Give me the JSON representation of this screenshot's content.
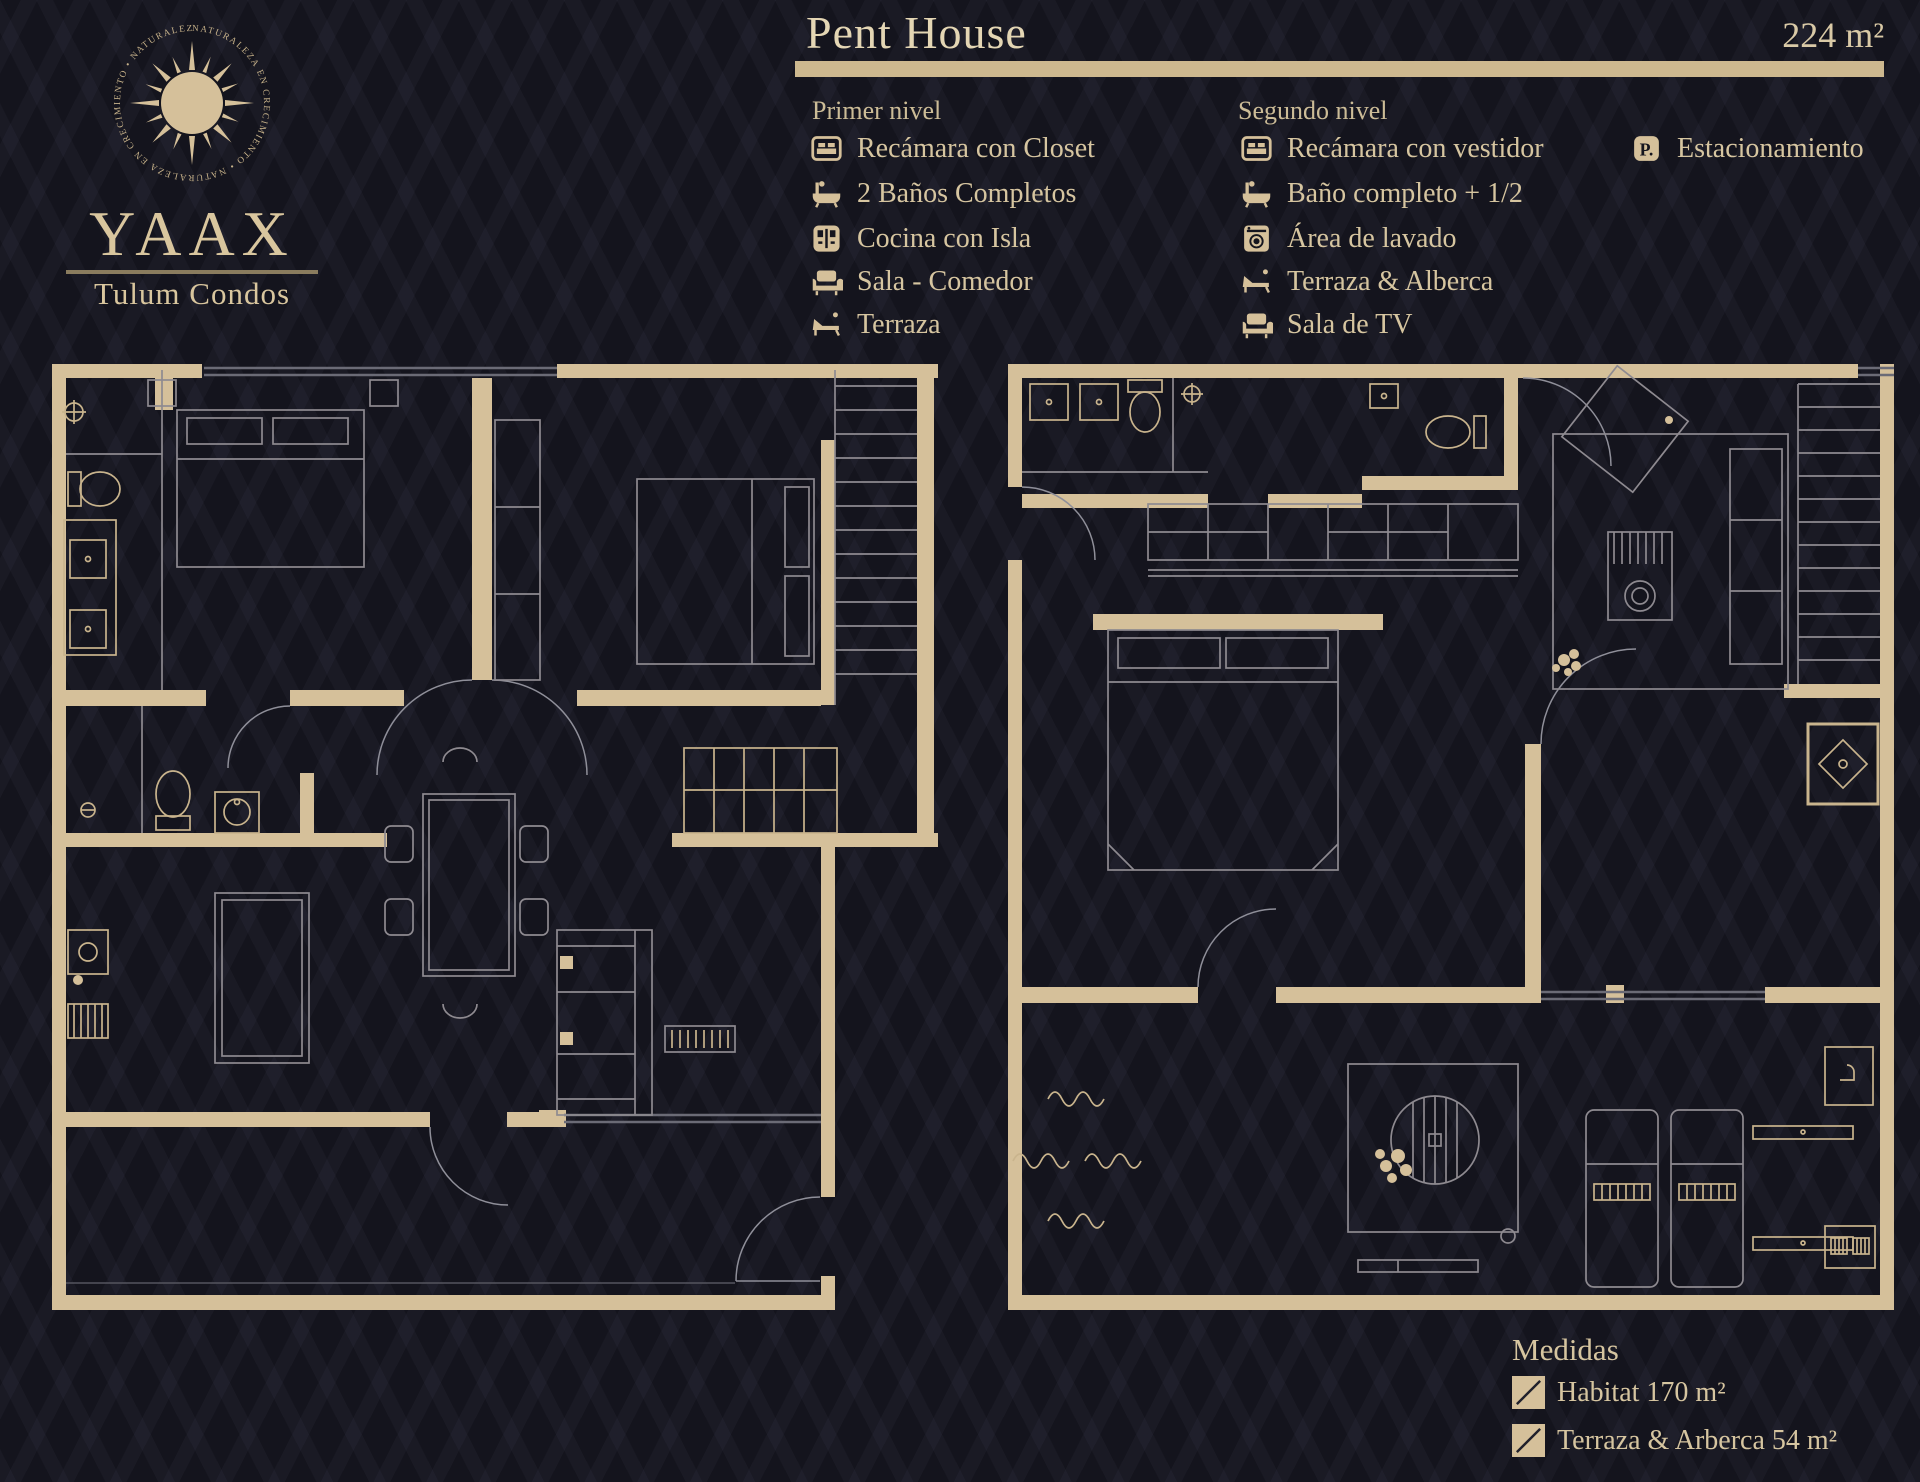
{
  "brand": {
    "name": "YAAX",
    "subtitle": "Tulum Condos",
    "ring_text": "NATURALEZA EN CRECIMIENTO • NATURALEZA EN CRECIMIENTO • NATURALEZA EN CRECIMIENTO • "
  },
  "header": {
    "title": "Pent House",
    "area": "224 m²"
  },
  "levels": [
    {
      "label": "Primer nivel",
      "items": [
        {
          "icon": "bed-icon",
          "label": "Recámara con Closet"
        },
        {
          "icon": "bath-icon",
          "label": "2 Baños Completos"
        },
        {
          "icon": "kitchen-icon",
          "label": "Cocina con Isla"
        },
        {
          "icon": "sofa-icon",
          "label": "Sala - Comedor"
        },
        {
          "icon": "lounge-icon",
          "label": "Terraza"
        }
      ]
    },
    {
      "label": "Segundo nivel",
      "items": [
        {
          "icon": "bed-icon",
          "label": "Recámara con vestidor"
        },
        {
          "icon": "bath-icon",
          "label": "Baño completo + 1/2"
        },
        {
          "icon": "washer-icon",
          "label": "Área de lavado"
        },
        {
          "icon": "lounge-icon",
          "label": "Terraza & Alberca"
        },
        {
          "icon": "sofa-icon",
          "label": "Sala de TV"
        }
      ]
    }
  ],
  "extra_feature": {
    "icon": "parking-icon",
    "label": "Estacionamiento"
  },
  "legend": {
    "title": "Medidas",
    "entries": [
      {
        "label": "Habitat 170 m²"
      },
      {
        "label": "Terraza & Arberca 54 m²"
      }
    ]
  },
  "floorplans": [
    {
      "name": "primer-nivel-floorplan"
    },
    {
      "name": "segundo-nivel-floorplan"
    }
  ],
  "colors": {
    "background": "#14141d",
    "wall_tan": "#d5c09a",
    "title_tan": "#e4d6b4",
    "text_tan": "#d6c5a0",
    "furniture_line": "#8e8a90",
    "rule_bar": "#cdb88f"
  }
}
